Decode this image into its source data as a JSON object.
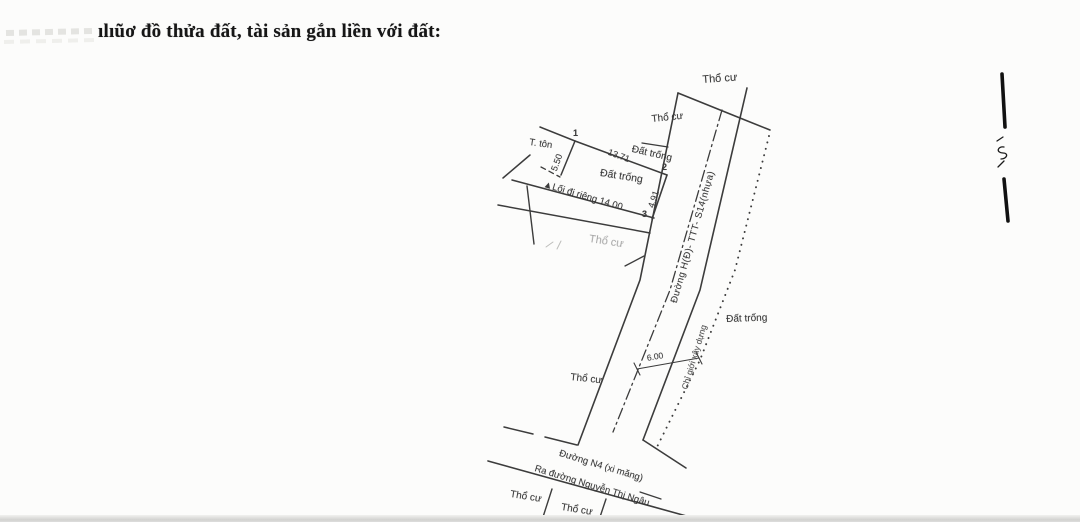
{
  "page": {
    "title": "ılıũơ đồ thửa đất, tài sản gắn liền với đất:"
  },
  "diagram": {
    "labels": {
      "tho_cu_top": "Thổ cư",
      "tho_cu_upper": "Thổ cư",
      "dat_trong_upper": "Đất trống",
      "dat_trong_parcel": "Đất trống",
      "dat_trong_right": "Đất trống",
      "tho_cu_mid_left": "Thổ cư",
      "tho_cu_faint": "Thổ cư",
      "tho_cu_bottom_1": "Thổ cư",
      "tho_cu_bottom_2": "Thổ cư",
      "t_ton": "T. tôn"
    },
    "vertices": {
      "point_1": "1",
      "point_2": "2",
      "point_3": "3"
    },
    "dimensions": {
      "top_edge": "13.71",
      "left_edge": "5.50",
      "right_edge": "4.91",
      "road_width": "6.00",
      "path_label": "▲Lối đi riêng 14.00"
    },
    "roads": {
      "main_road": "Đường H(Đ)- TTT- S14(nhựa)",
      "setback_line": "Chỉ giới xây dựng",
      "bottom_road": "Đường N4 (xi măng)",
      "direction_note": "Ra đường Nguyễn Thị Ngâu"
    },
    "ink_color": "#3c3c3c",
    "faint_color": "#a3a3a3"
  }
}
